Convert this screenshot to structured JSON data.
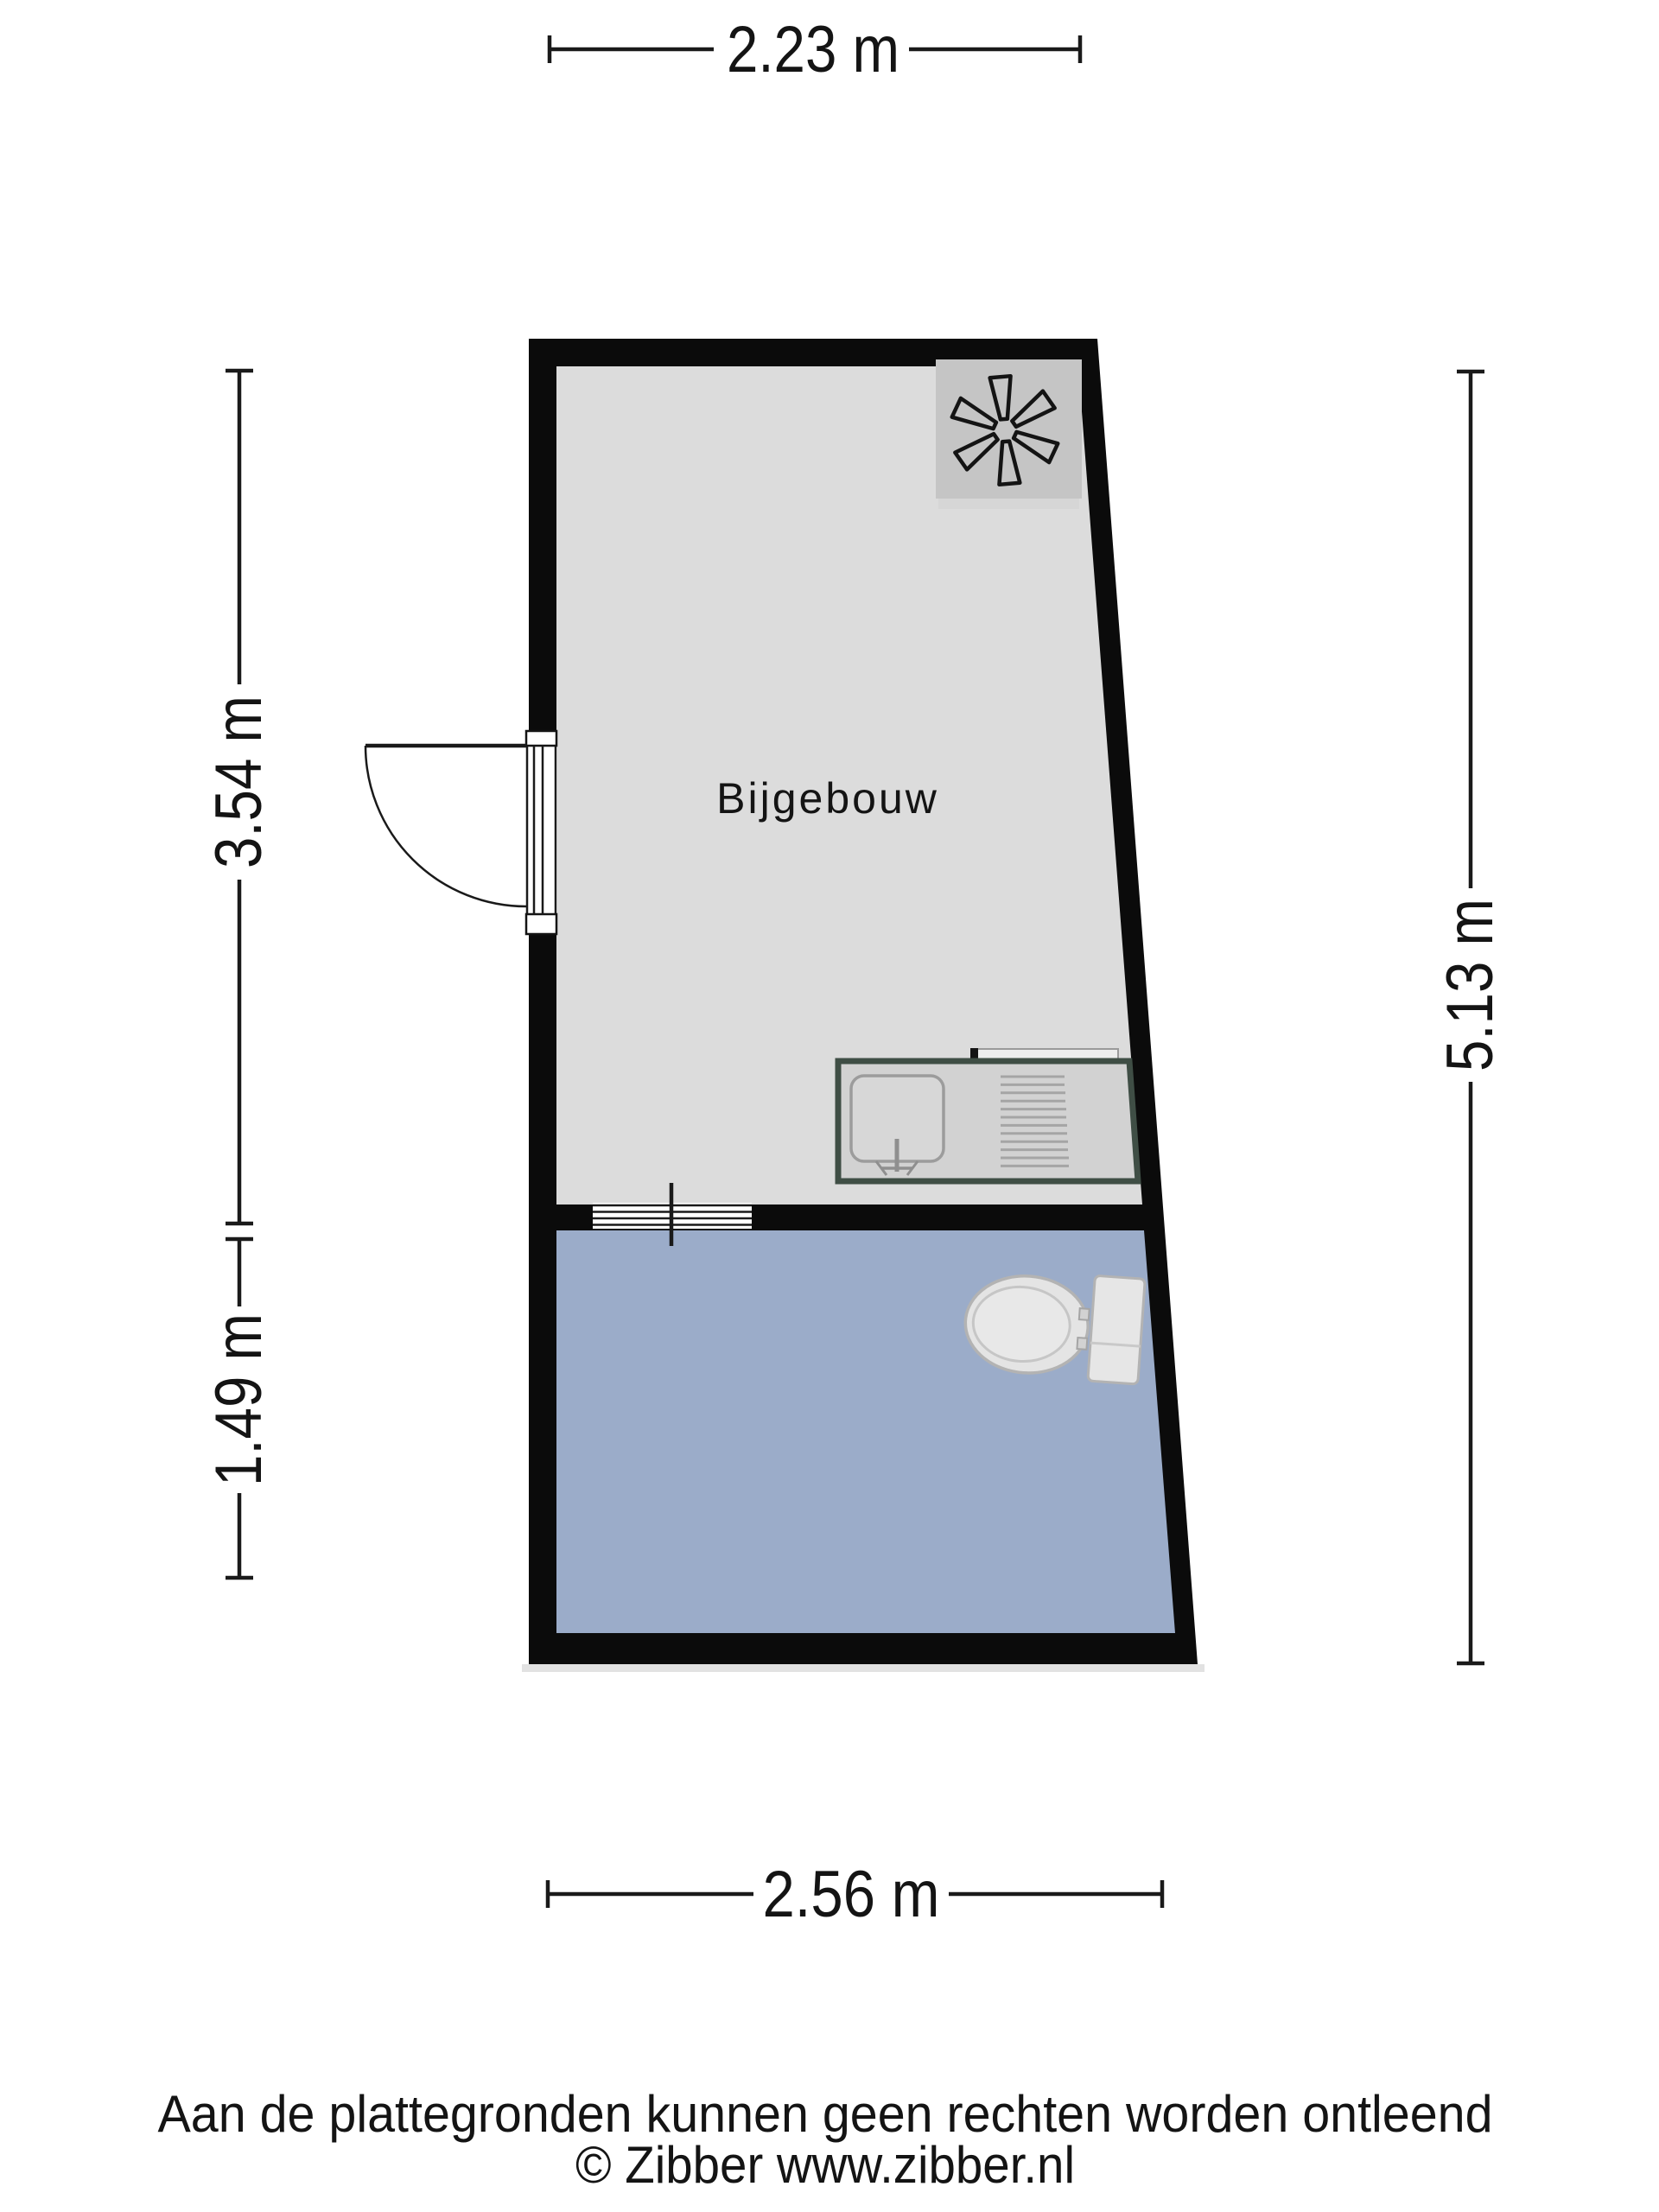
{
  "plan": {
    "room_label": "Bijgebouw",
    "dimensions": {
      "top": "2.23 m",
      "left_upper": "3.54 m",
      "left_lower": "1.49 m",
      "right": "5.13 m",
      "bottom": "2.56 m"
    },
    "fixtures": {
      "fan": "extractor-fan",
      "sink": "kitchen-sink-with-drainer",
      "toilet": "toilet",
      "door": "door-swing",
      "interior_opening": "sliding-threshold"
    }
  },
  "footer": {
    "disclaimer": "Aan de plattegronden kunnen geen rechten worden ontleend",
    "copyright": "© Zibber www.zibber.nl"
  },
  "colors": {
    "wall": "#0b0b0b",
    "line": "#1a1a1a",
    "room_gray": "#dcdcdc",
    "room_blue": "#9bacc9",
    "counter_border": "#3f4e45",
    "fixture_gray": "#d2d2d2",
    "unit_gray": "#c5c5c5"
  }
}
